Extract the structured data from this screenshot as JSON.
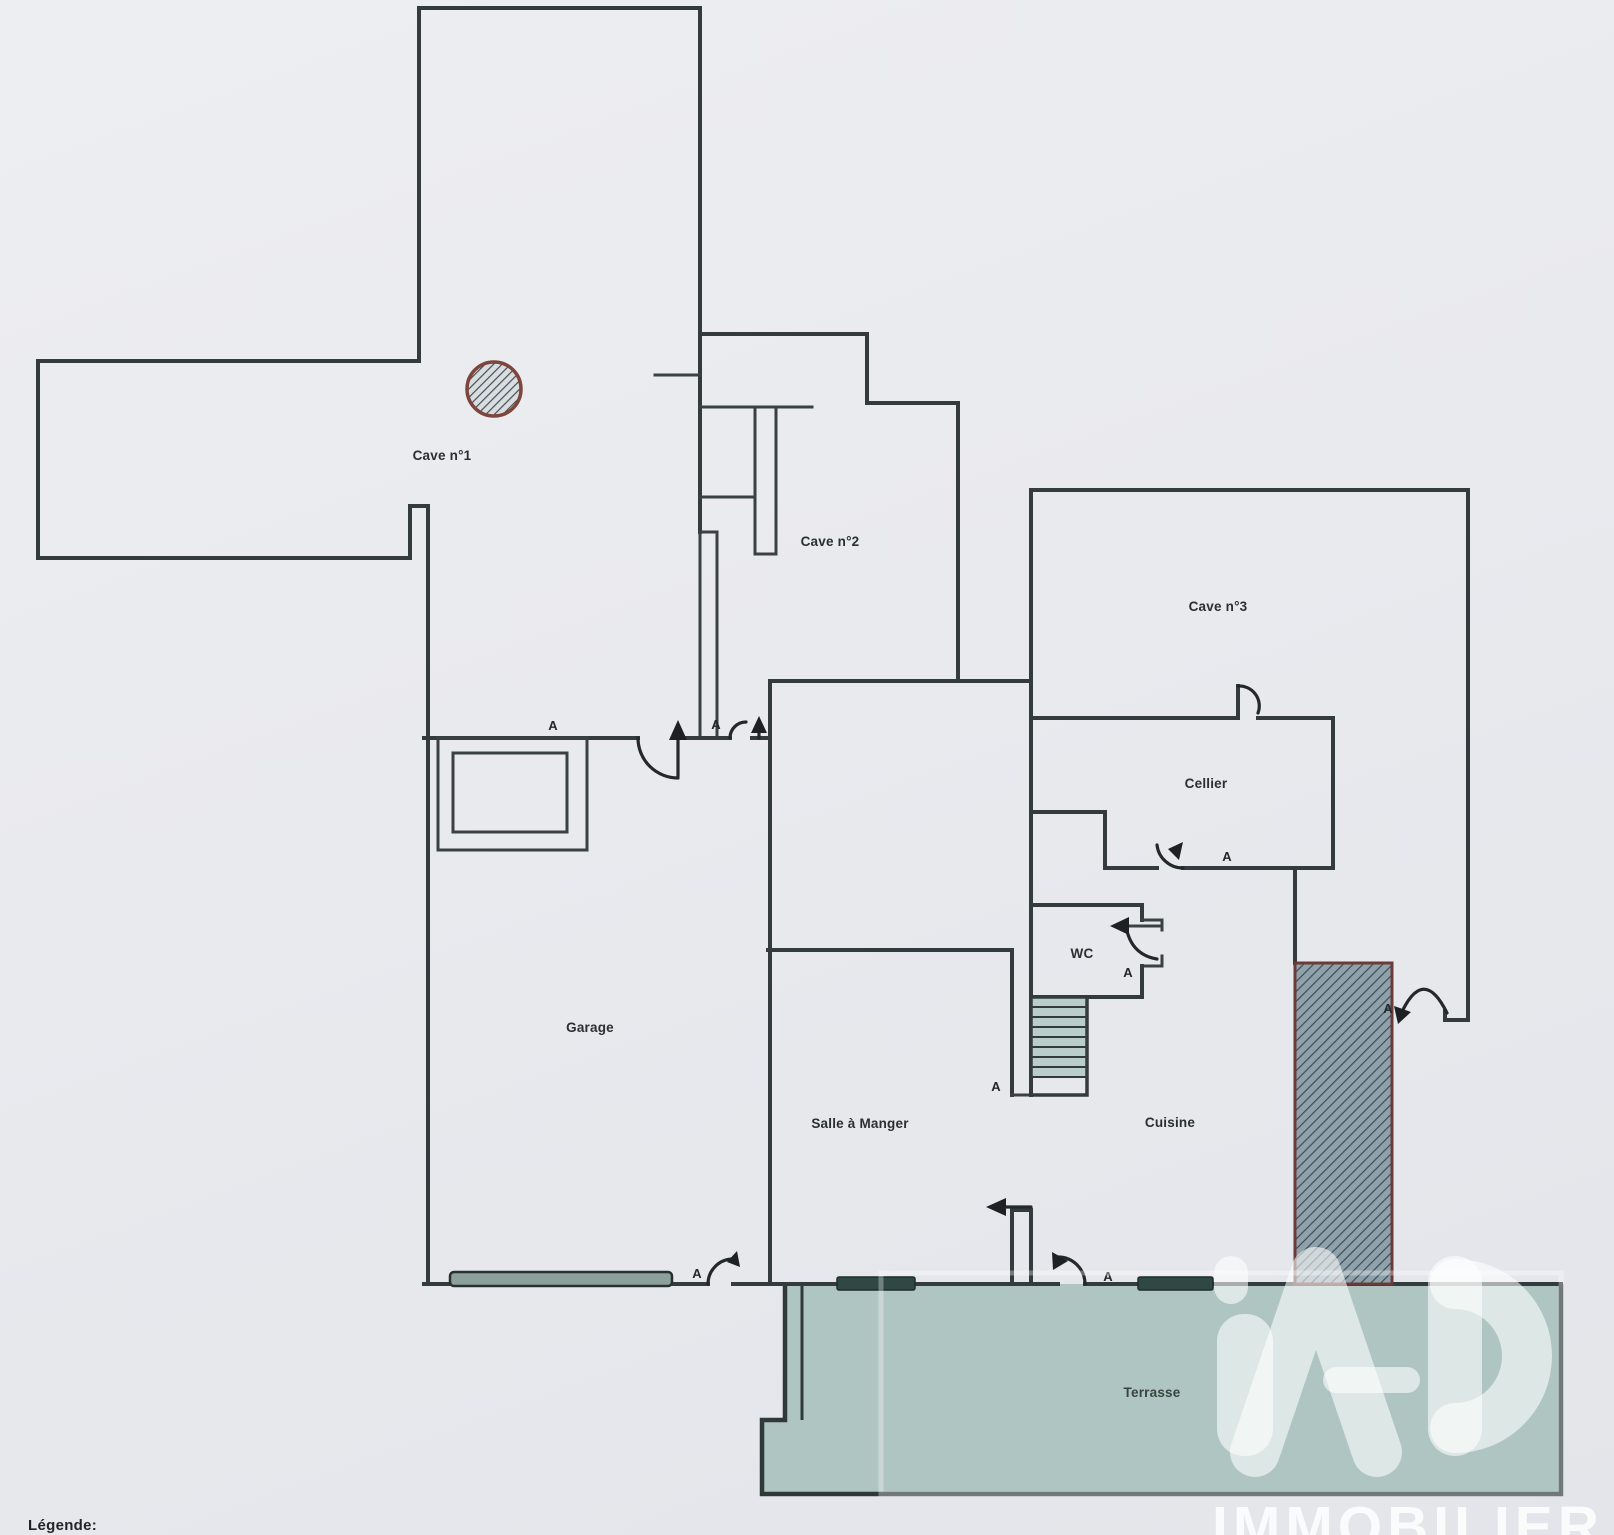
{
  "rooms": {
    "cave1": "Cave n°1",
    "cave2": "Cave n°2",
    "cave3": "Cave n°3",
    "cellier": "Cellier",
    "wc": "WC",
    "garage": "Garage",
    "salle_a_manger": "Salle à Manger",
    "cuisine": "Cuisine",
    "terrasse": "Terrasse"
  },
  "doors": {
    "label": "A"
  },
  "legend": {
    "title": "Légende:"
  },
  "watermark": {
    "logo": "iAD",
    "subtitle": "IMMOBILIER"
  },
  "colors": {
    "paper": "#e9eaee",
    "wall": "#343b3c",
    "terrace_fill": "#aec5c1",
    "stair_fill": "#b9cdc9",
    "window_bar": "#2f4843",
    "garage_door_fill": "#8da09c",
    "hatch_box_fill": "#8fa2ac",
    "hatch_box_border": "#6b3b39",
    "hatch_line": "#3c4c55",
    "pillar_border": "#7d453c",
    "watermark_white": "#ffffff"
  }
}
